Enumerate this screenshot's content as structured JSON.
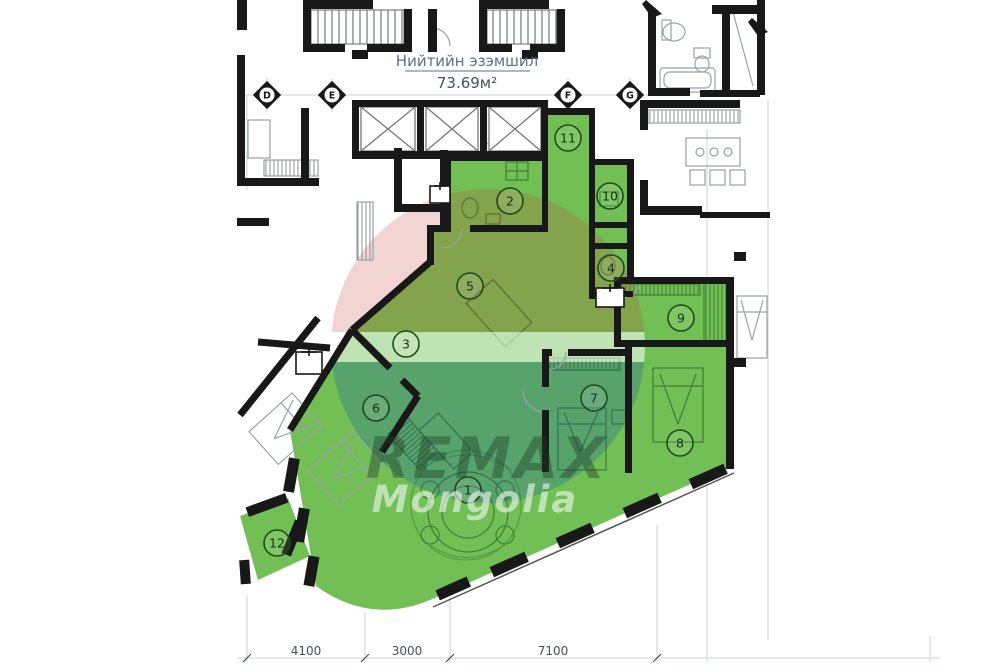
{
  "title": {
    "label": "Нийтийн эзэмшил",
    "area": "73.69м²"
  },
  "grid_markers": [
    "D",
    "E",
    "F",
    "G"
  ],
  "rooms": [
    {
      "n": "1"
    },
    {
      "n": "2"
    },
    {
      "n": "3"
    },
    {
      "n": "4"
    },
    {
      "n": "5"
    },
    {
      "n": "6"
    },
    {
      "n": "7"
    },
    {
      "n": "8"
    },
    {
      "n": "9"
    },
    {
      "n": "10"
    },
    {
      "n": "11"
    },
    {
      "n": "12"
    }
  ],
  "dimensions": [
    "4100",
    "3000",
    "7100"
  ],
  "watermark": {
    "line1": "REMAX",
    "line2": "Mongolia"
  },
  "palette": {
    "highlight_green": "#72c055",
    "furniture_green": "#3f7d33",
    "wall_black": "#181818",
    "balloon_red": "#c43c30",
    "balloon_blue": "#1556a8",
    "faint_line": "#c9d0d6",
    "text_gray": "#6b7b8c"
  }
}
